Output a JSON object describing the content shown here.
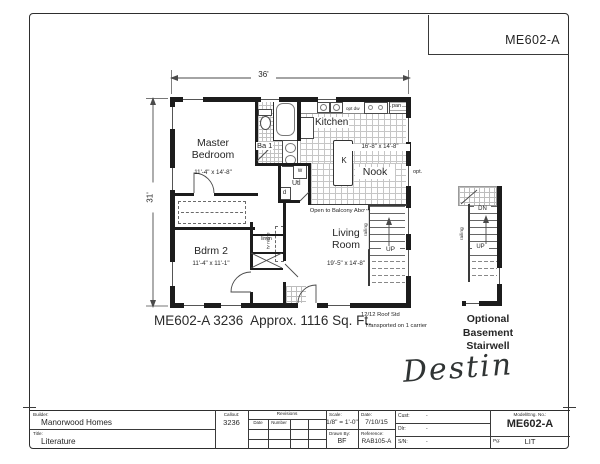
{
  "page": {
    "corner_model": "ME602-A",
    "caption": "ME602-A 3236  Approx. 1116 Sq. Ft.",
    "roof_note_line1": "12/12 Roof Std",
    "roof_note_line2": "Transported on 1 carrier",
    "basement_caption": "Optional\nBasement\nStairwell",
    "signature": "Destin"
  },
  "plan": {
    "dim_width": "36'",
    "dim_height": "31'",
    "master_bedroom": {
      "name": "Master\nBedroom",
      "dim": "11'-4\" x 14'-8\""
    },
    "bath1": {
      "name": "Ba 1"
    },
    "kitchen": {
      "name": "Kitchen",
      "island": "K",
      "dim": "16'-8\" x 14'-8\"",
      "pantry": "pan",
      "opt_dishwasher": "opt dw"
    },
    "nook": {
      "name": "Nook",
      "opt_window": "opt."
    },
    "utility": {
      "name": "Utl",
      "washer": "w",
      "dryer": "d"
    },
    "living_room": {
      "name": "Living\nRoom",
      "dim": "19'-5\" x 14'-8\"",
      "balcony_note": "Open to Balcony Above"
    },
    "bedroom2": {
      "name": "Bdrm 2",
      "dim": "11'-4\" x 11'-1\""
    },
    "closets": {
      "linen": "linen",
      "tv_niche": "tv niche"
    },
    "stairs": {
      "up": "UP",
      "railing": "railing"
    },
    "basement_stairs": {
      "down": "DN",
      "up": "UP",
      "railing": "railing"
    }
  },
  "titleblock": {
    "builder_label": "Builder:",
    "builder_value": "Manorwood Homes",
    "title_label": "Title:",
    "title_value": "Literature",
    "callout_label": "Callout:",
    "callout_value": "3236",
    "revisions_label": "Revisions",
    "rev_date_label": "Date",
    "rev_number_label": "Number",
    "scale_label": "Scale:",
    "scale_value": "1/8\" = 1'-0\"",
    "drawnby_label": "Drawn By:",
    "drawnby_value": "BF",
    "date_label": "Date:",
    "date_value": "7/10/15",
    "reference_label": "Reference:",
    "reference_value": "RAB105-A",
    "cust_label": "Cust:",
    "cust_value": "-",
    "dlr_label": "Dlr:",
    "dlr_value": "-",
    "sn_label": "S/N:",
    "sn_value": "-",
    "model_label": "Model/Eng. No.:",
    "model_value": "ME602-A",
    "pg_label": "Pg:",
    "pg_value": "LIT"
  }
}
